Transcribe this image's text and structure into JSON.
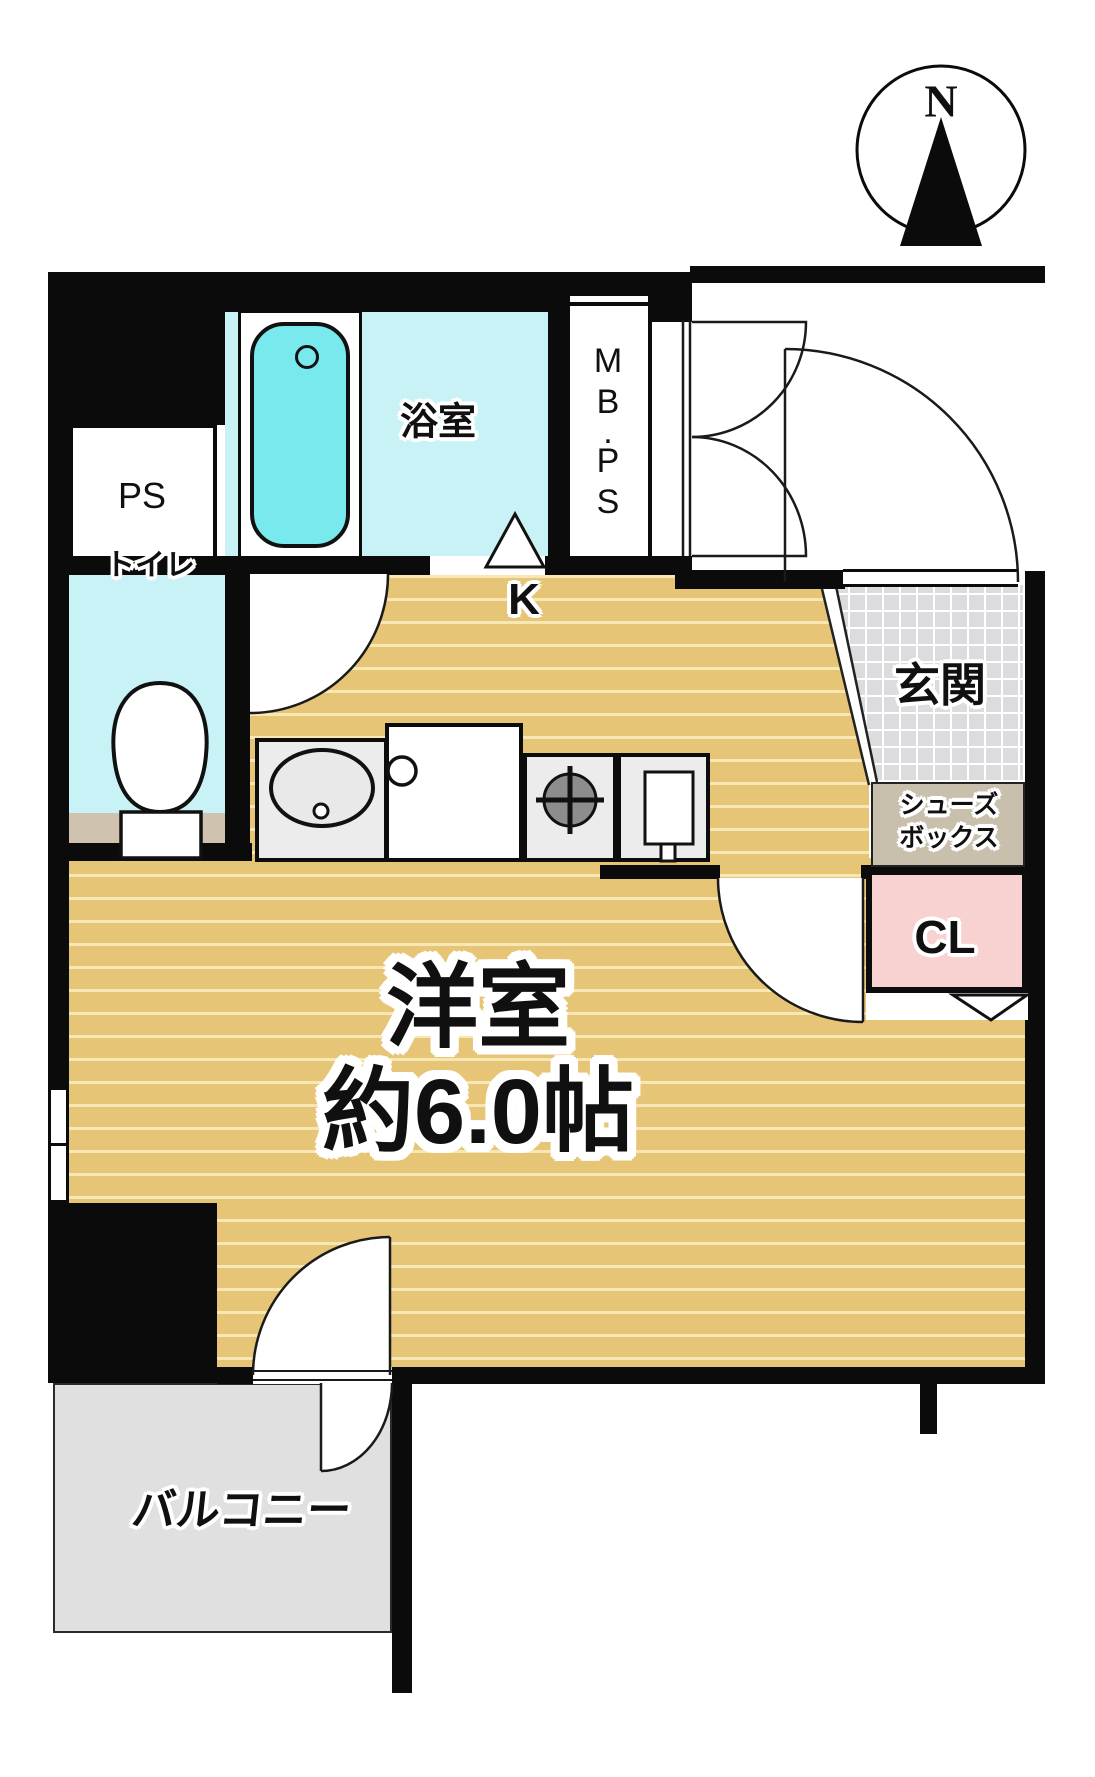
{
  "compass": {
    "north_label": "N"
  },
  "rooms": {
    "bathroom": {
      "label": "浴室"
    },
    "ps": {
      "label": "PS"
    },
    "mbps": {
      "label": "MB.PS",
      "chars": [
        "M",
        "B",
        ".",
        "P",
        "S"
      ]
    },
    "toilet": {
      "label": "トイレ"
    },
    "kitchen": {
      "label": "K"
    },
    "entrance": {
      "label": "玄関"
    },
    "shoebox": {
      "label_line1": "シューズ",
      "label_line2": "ボックス"
    },
    "closet": {
      "label": "CL"
    },
    "main_room": {
      "label_line1": "洋室",
      "label_line2": "約6.0帖"
    },
    "balcony": {
      "label": "バルコニー"
    }
  },
  "colors": {
    "wall": "#0b0b0b",
    "floor_tan": "#e7c576",
    "floor_tan_stripe": "#f6e7b5",
    "wet_room_cyan": "#c9f2f6",
    "bathtub_cyan": "#78e9ec",
    "entrance_tile_gray": "#dcdcdf",
    "shoebox_beige": "#c9bfad",
    "closet_pink": "#f8d1d1",
    "balcony_gray": "#e0e0e0",
    "toilet_step_beige": "#cfc2ae",
    "counter_gray": "#ececec",
    "burner_gray": "#8d8d8d"
  }
}
